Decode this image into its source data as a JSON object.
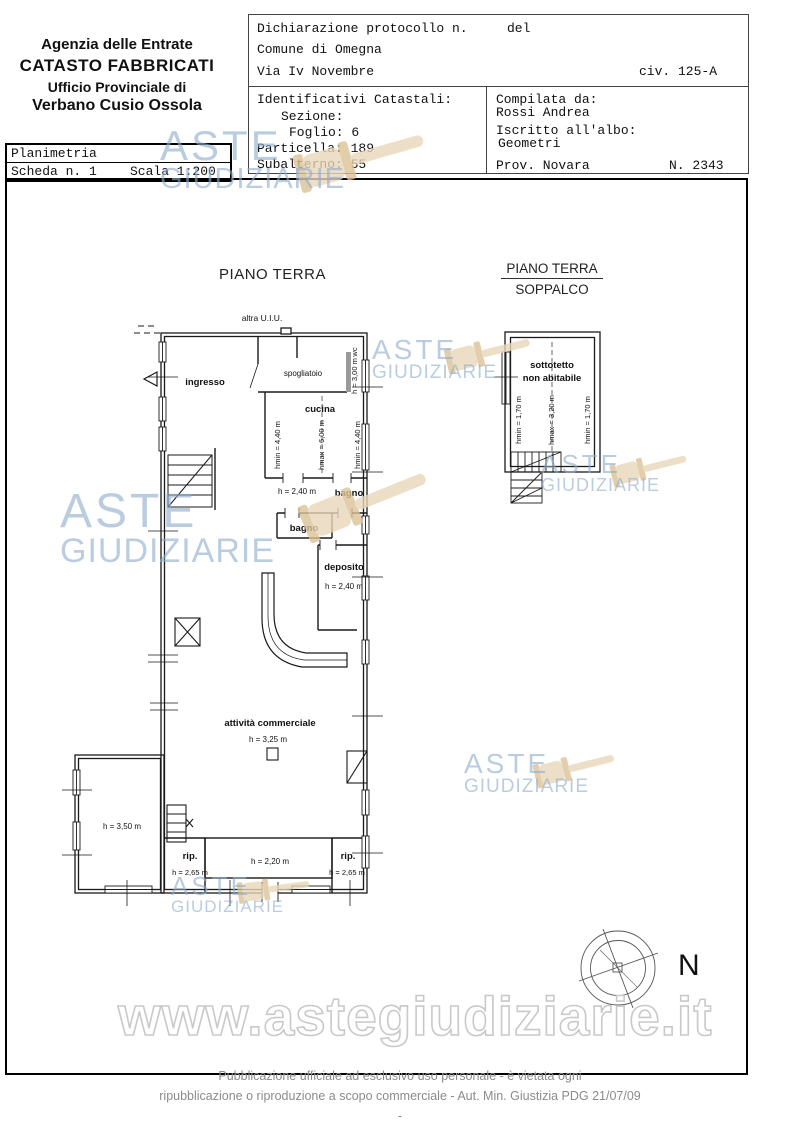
{
  "header": {
    "agency_line1": "Agenzia delle Entrate",
    "agency_line2": "CATASTO FABBRICATI",
    "agency_line3": "Ufficio Provinciale di",
    "agency_line4": "Verbano Cusio Ossola",
    "declaration": {
      "protocol_label": "Dichiarazione protocollo n.",
      "del_label": "del",
      "comune": "Comune di Omegna",
      "street": "Via Iv Novembre",
      "civic": "civ. 125-A"
    },
    "cadastral": {
      "title": "Identificativi Catastali:",
      "sezione": "Sezione:",
      "foglio": "Foglio: 6",
      "particella": "Particella: 189",
      "subalterno": "Subalterno: 55"
    },
    "compiler": {
      "label": "Compilata da:",
      "name": "Rossi Andrea",
      "albo_label": "Iscritto all'albo:",
      "albo": "Geometri",
      "prov": "Prov. Novara",
      "number": "N. 2343"
    }
  },
  "doc_info": {
    "type": "Planimetria",
    "sheet": "Scheda n. 1",
    "scale": "Scala 1:200"
  },
  "plan": {
    "floor_title": "PIANO TERRA",
    "mezzanine_title_line1": "PIANO TERRA",
    "mezzanine_title_line2": "SOPPALCO",
    "other_unit": "altra U.I.U.",
    "compass_label": "N",
    "rooms": {
      "ingresso": "ingresso",
      "spogliatoio": "spogliatoio",
      "wc": "wc",
      "wc_height": "h = 3,00 m",
      "cucina": "cucina",
      "cucina_hmin_left": "hmin = 4,40 m",
      "cucina_hmax": "hmax = 6,00 m",
      "cucina_hmin_right": "hmin = 4,40 m",
      "door_height": "h = 2,40 m",
      "bagno1": "bagno",
      "bagno2": "bagno",
      "deposito": "deposito",
      "deposito_height": "h = 2,40 m",
      "attivita": "attività commerciale",
      "attivita_height": "h = 3,25 m",
      "annex_height": "h = 3,50 m",
      "rip_left": "rip.",
      "rip_left_height": "h = 2,65 m",
      "central_height": "h = 2,20 m",
      "rip_right": "rip.",
      "rip_right_height": "h = 2,65 m",
      "sottotetto_line1": "sottotetto",
      "sottotetto_line2": "non abitabile",
      "sop_hmin_left": "hmin = 1,70 m",
      "sop_hmax": "hmax = 3,20 m",
      "sop_hmin_right": "hmin = 1,70 m"
    }
  },
  "watermark": {
    "line1": "ASTE",
    "line2": "GIUDIZIARIE",
    "url": "www.astegiudiziarie.it",
    "blue": "#8fadcd",
    "beige": "#e7d5b5"
  },
  "footer": {
    "line1": "Pubblicazione ufficiale ad esclusivo uso personale - è vietata ogni",
    "line2": "ripubblicazione o riproduzione a scopo commerciale - Aut. Min. Giustizia PDG 21/07/09",
    "line3": "-"
  }
}
